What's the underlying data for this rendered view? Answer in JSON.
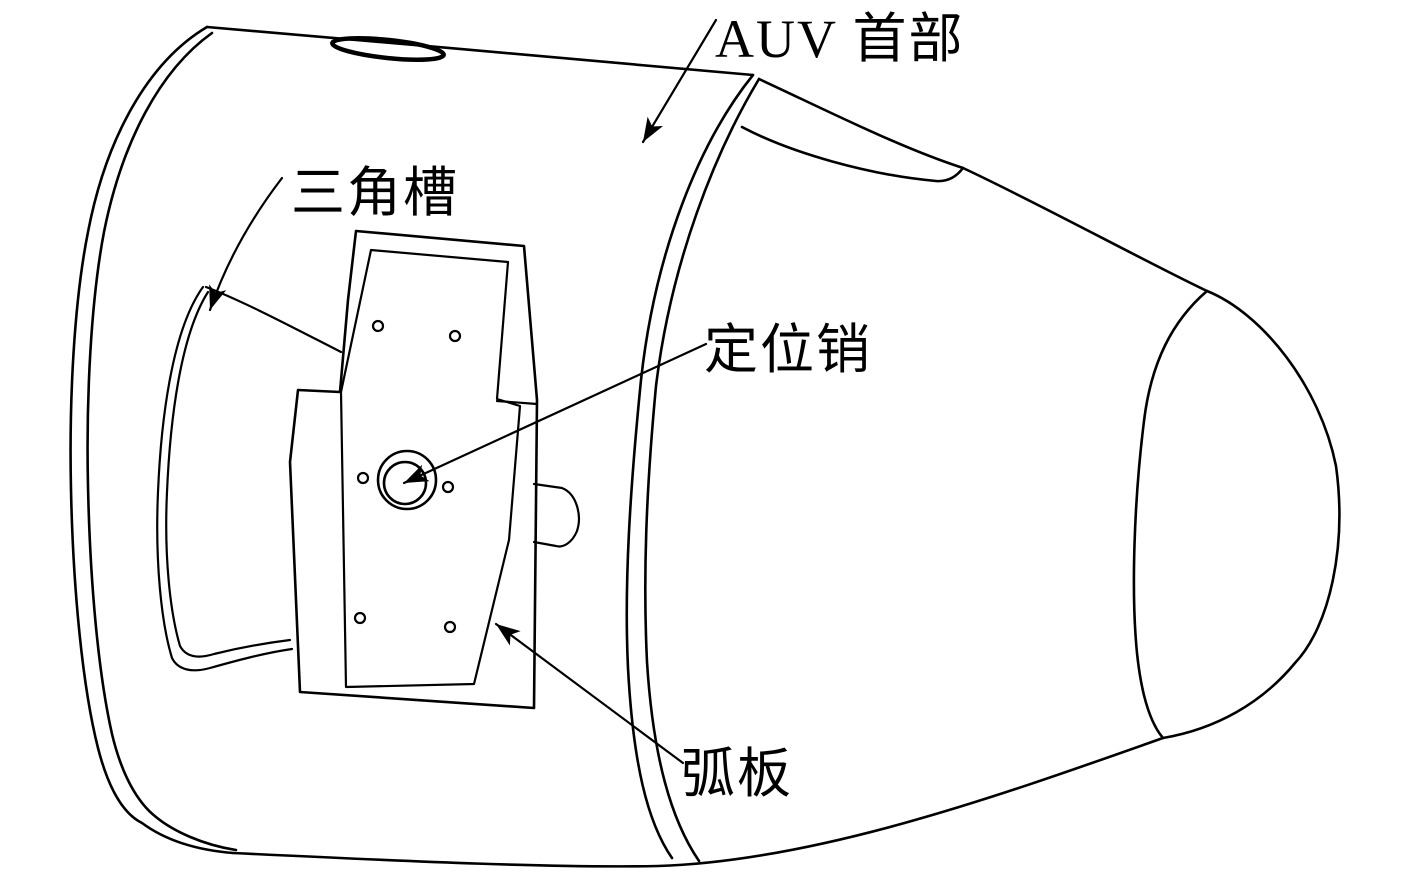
{
  "figure": {
    "type": "engineering-line-drawing",
    "subject": "AUV head section with docking plate",
    "background_color": "#ffffff",
    "stroke_color": "#000000",
    "labels": {
      "auv_head": "AUV 首部",
      "triangular_groove": "三角槽",
      "positioning_pin": "定位销",
      "arc_plate": "弧板"
    }
  }
}
